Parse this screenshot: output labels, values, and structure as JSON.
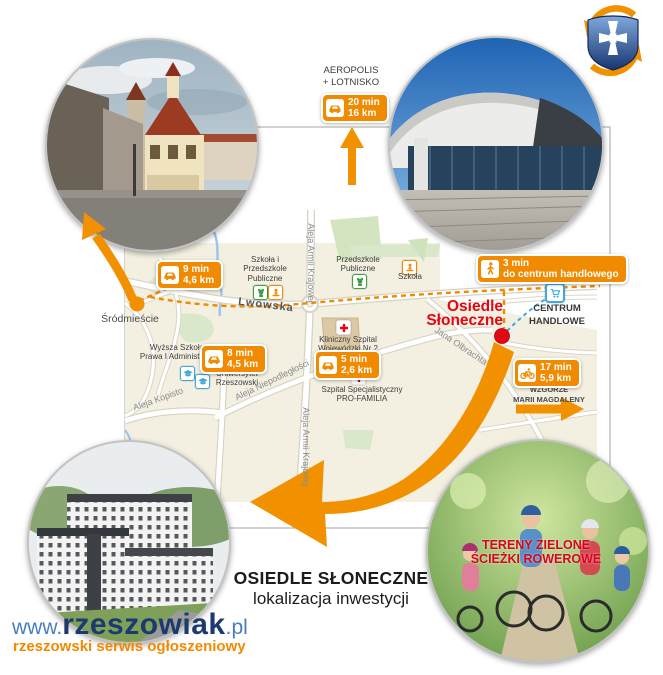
{
  "aeropolis": {
    "line1": "AEROPOLIS",
    "line2": "+ LOTNISKO"
  },
  "badges": {
    "airport": {
      "time": "20 min",
      "dist": "16 km"
    },
    "srodmiescie": {
      "time": "9 min",
      "dist": "4,6 km"
    },
    "university": {
      "time": "8 min",
      "dist": "4,5 km"
    },
    "hospital": {
      "time": "5 min",
      "dist": "2,6 km"
    },
    "mall": {
      "time": "3 min",
      "dist": "do centrum handlowego"
    },
    "hill": {
      "time": "17 min",
      "dist": "5,9 km"
    }
  },
  "map": {
    "streets": {
      "lwowska": "Lwowska",
      "armii_krajowej": "Aleja Armii Krajowej",
      "niepodleglosci": "Aleja Niepodległości",
      "kopisto": "Aleja Kopisto",
      "olbrachta": "Jana Olbrachta"
    },
    "places": {
      "srodmiescie": "Śródmieście",
      "school1_l1": "Szkoła i",
      "school1_l2": "Przedszkole",
      "school1_l3": "Publiczne",
      "preschool_l1": "Przedszkole",
      "preschool_l2": "Publiczne",
      "school2": "Szkoła",
      "wsspia_l1": "Wyższa Szkoła",
      "wsspia_l2": "Prawa I Administracji",
      "uni_l1": "Uniwersytet",
      "uni_l2": "Rzeszowski",
      "hospital1_l1": "Kliniczny Szpital",
      "hospital1_l2": "Wojewódzki Nr 2",
      "hospital2_l1": "Szpital Specjalistyczny",
      "hospital2_l2": "PRO-FAMILIA",
      "estate_l1": "Osiedle",
      "estate_l2": "Słoneczne",
      "mall_l1": "CENTRUM",
      "mall_l2": "HANDLOWE",
      "hill_l1": "WZGÓRZE",
      "hill_l2": "MARII MAGDALENY"
    }
  },
  "photos": {
    "bikes_caption_l1": "TERENY ZIELONE",
    "bikes_caption_l2": "ŚCIEŻKI ROWEROWE"
  },
  "title": {
    "line1": "OSIEDLE SŁONECZNE",
    "line2": "lokalizacja inwestycji"
  },
  "footer": {
    "www": "www.",
    "brand": "rzeszowiak",
    "tld": ".pl",
    "tagline": "rzeszowski serwis ogłoszeniowy"
  },
  "colors": {
    "orange": "#F08A00",
    "red": "#E30613",
    "blue": "#3FA9DC",
    "navy": "#1D3A70",
    "cream": "#F3EFE1"
  }
}
